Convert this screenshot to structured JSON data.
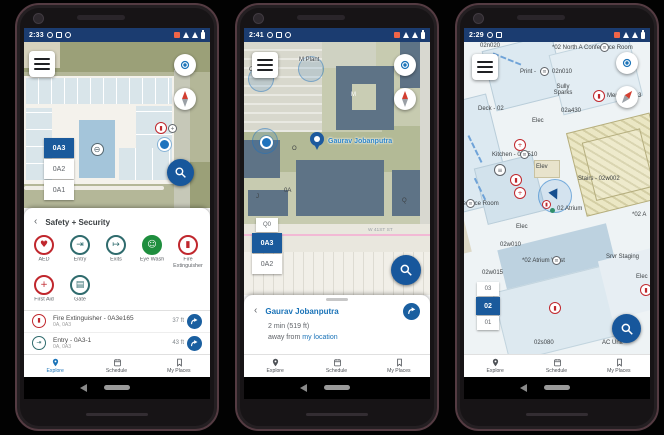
{
  "colors": {
    "status_navy": "#1b3c70",
    "primary_blue": "#17579c",
    "link_blue": "#1a73b8",
    "selected_floor_blue": "#1a5a9c",
    "safety_red": "#c0272d",
    "safety_teal": "#2f6b6d",
    "safety_green": "#1e8e3e",
    "map_khaki": "#b4b798",
    "building_slate": "#5e7386"
  },
  "nav": {
    "explore": "Explore",
    "schedule": "Schedule",
    "places": "My Places"
  },
  "phone1": {
    "status_time": "2:33",
    "map": {
      "room_label": "0A3e",
      "elevator_glyph": "⊖",
      "poi_fire_glyph": "▮",
      "poi_gray_glyph": "+",
      "floors": [
        "0A3",
        "0A2",
        "0A1"
      ],
      "selected_floor": "0A3"
    },
    "sheet": {
      "back": "‹",
      "title": "Safety + Security",
      "categories": [
        {
          "label": "AED",
          "glyph": "♥"
        },
        {
          "label": "Entry",
          "glyph": "⇥"
        },
        {
          "label": "Exits",
          "glyph": "↦"
        },
        {
          "label": "Eye Wash",
          "glyph": "☺"
        },
        {
          "label": "Fire Extinguisher",
          "glyph": "▮"
        },
        {
          "label": "First Aid",
          "glyph": "+"
        },
        {
          "label": "Gate",
          "glyph": "▤"
        }
      ],
      "items": [
        {
          "glyph": "▮",
          "title": "Fire Extinguisher - 0A3e165",
          "subtitle": "0A, 0A3",
          "distance": "37 ft"
        },
        {
          "glyph": "⇥",
          "title": "Entry - 0A3-1",
          "subtitle": "0A, 0A3",
          "distance": "43 ft"
        }
      ]
    }
  },
  "phone2": {
    "status_time": "2:41",
    "map": {
      "labels": {
        "m_plant": "M Plant",
        "o_plant": "O Plant",
        "m": "M",
        "o": "O",
        "oa": "0A",
        "q": "Q",
        "j": "J",
        "street": "W 41ST ST"
      },
      "person_label": "Gaurav Jobanputra",
      "floors": [
        "Q0",
        "0A3",
        "0A2"
      ],
      "selected_floor": "0A3"
    },
    "sheet": {
      "back": "‹",
      "title": "Gaurav Jobanputra",
      "line1": "2 min (519 ft)",
      "line2_prefix": "away from ",
      "line2_link": "my location"
    }
  },
  "phone3": {
    "status_time": "2:29",
    "map": {
      "labels": {
        "n020": "02n020",
        "north_conf": "*02 North A Conference Room",
        "print": "Print -",
        "print_room": "02n010",
        "sully": "Sully Sparks",
        "mens": "Men's - 02a3",
        "deck": "Deck - 02",
        "elec": "Elec",
        "a430": "02a430",
        "kitchen": "Kitchen - 02a510",
        "elev": "Elev",
        "stairs": "Stairs - 02w002",
        "atrium": "02 Atrium",
        "conf": "Conference Room",
        "w010": "02w010",
        "w015": "02w015",
        "atrium_west": "*02 Atrium West",
        "srvr": "Srvr Staging",
        "s080": "02s080",
        "ac": "AC Unit",
        "partial": "*02 A"
      },
      "floors": [
        "03",
        "02",
        "01"
      ],
      "selected_floor": "02"
    }
  }
}
